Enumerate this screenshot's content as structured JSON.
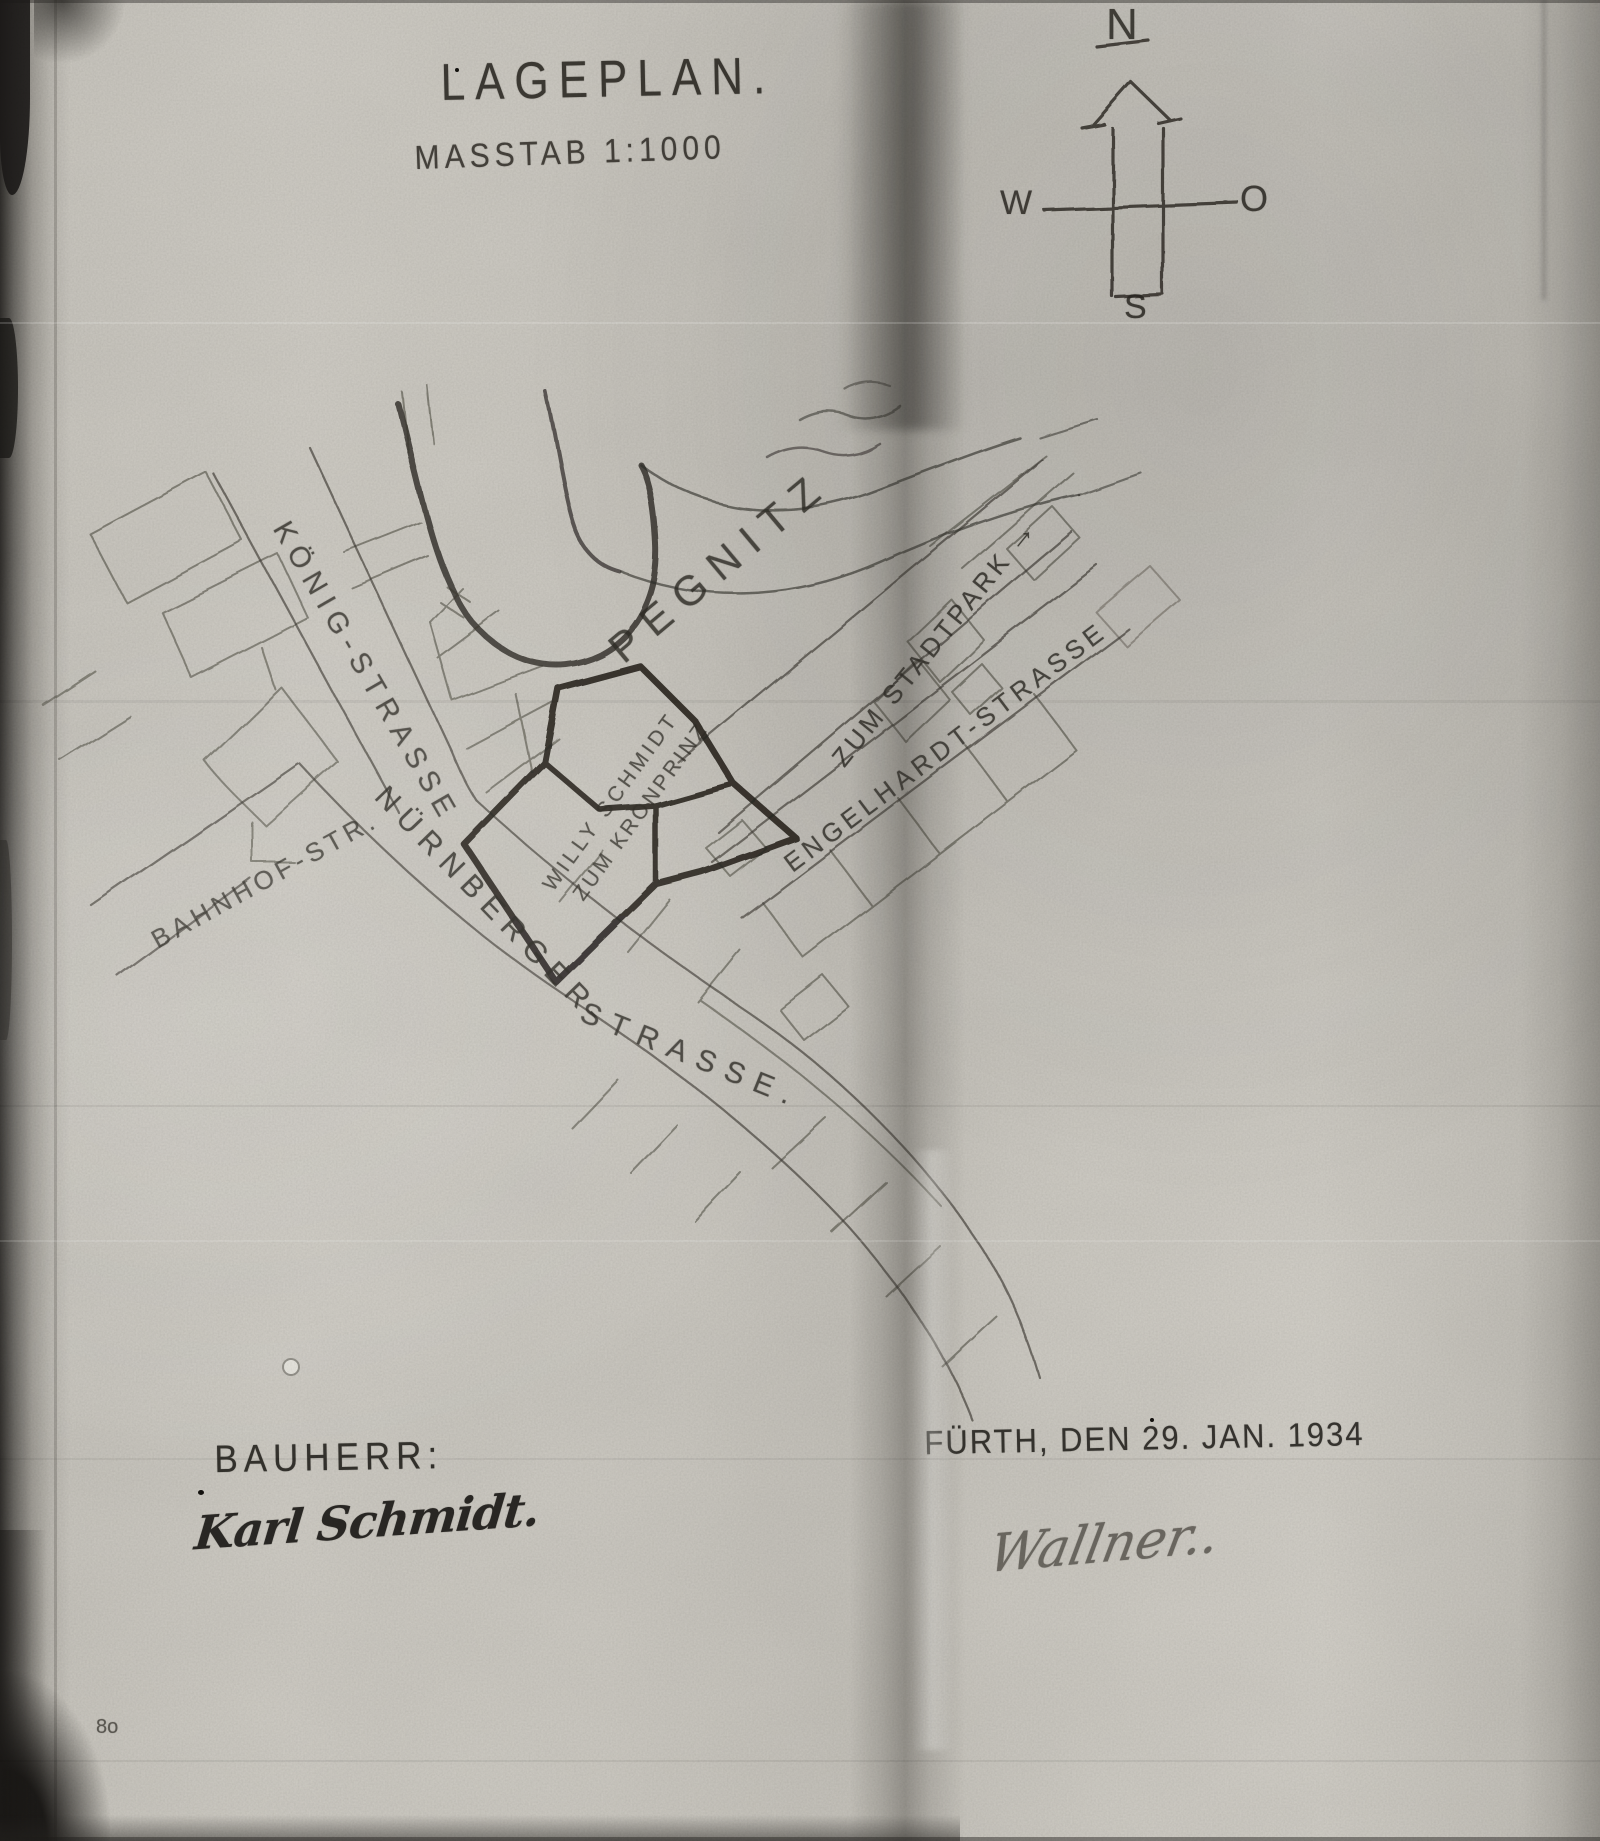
{
  "colors": {
    "paper": "#cfccc6",
    "ink": "#2b2823"
  },
  "document": {
    "title": "LAGEPLAN.",
    "scale": "MASSTAB 1:1000"
  },
  "compass": {
    "north": "N",
    "east": "O",
    "south": "S",
    "west": "W"
  },
  "map": {
    "river": "PEGNITZ",
    "streets": {
      "koenig": "KÖNIG-STRASSE",
      "bahnhof": "BAHNHOF-STR.",
      "nuernberger_upper": "NÜRNBERGER-",
      "nuernberger_lower": "STRASSE.",
      "engelhardt": "ENGELHARDT-STRASSE",
      "stadtpark": "ZUM STADTPARK",
      "stadtpark_arrow": "→"
    },
    "plot": {
      "owner": "WILLY SCHMIDT",
      "name": "ZUM KRONPRINZ"
    }
  },
  "footer": {
    "client_label": "BAUHERR:",
    "client_signature": "Karl Schmidt.",
    "place_date": "FÜRTH, DEN 29. JAN. 1934",
    "approval_signature": "Wallner..",
    "corner_mark": "8o"
  }
}
